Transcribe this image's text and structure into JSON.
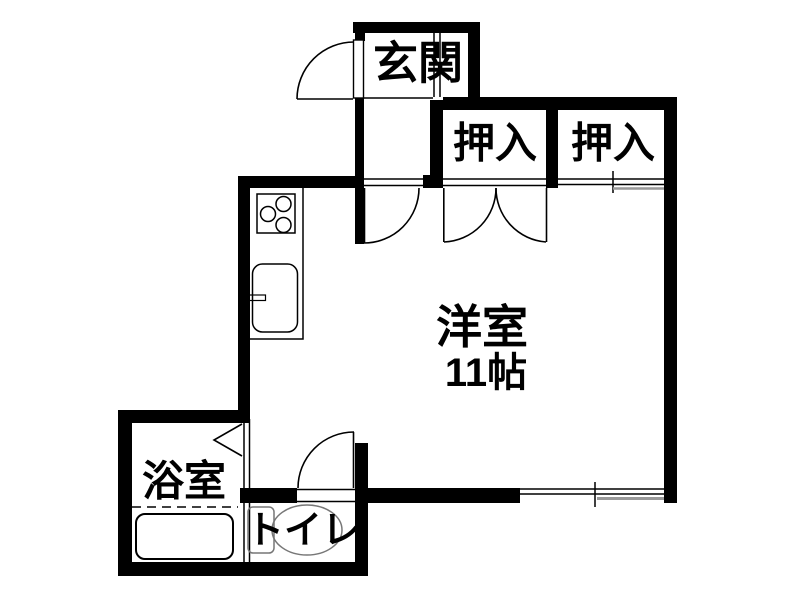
{
  "rooms": {
    "genkan": "玄関",
    "closet_left": "押入",
    "closet_right": "押入",
    "main_room": "洋室",
    "main_room_size": "11帖",
    "bathroom": "浴室",
    "toilet": "トイレ"
  },
  "colors": {
    "wall": "#000000",
    "background": "#ffffff",
    "sash_gray": "#999999",
    "fixture_gray": "#777777"
  }
}
